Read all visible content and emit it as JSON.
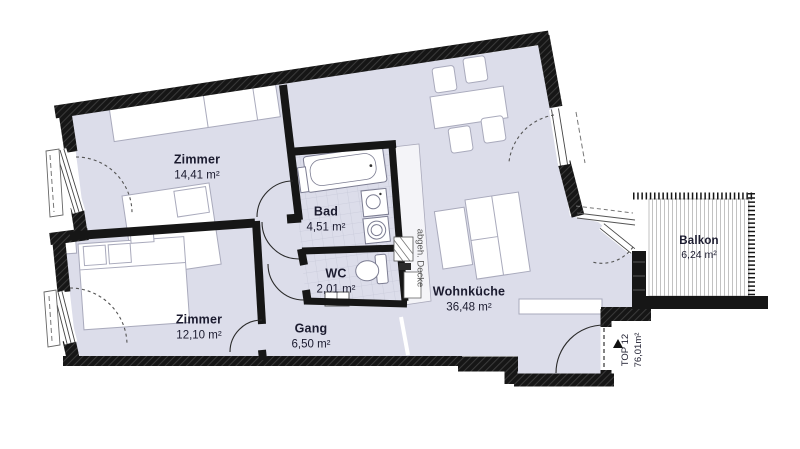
{
  "plan": {
    "title": "Wohnungsplan TOP 12",
    "rooms": [
      {
        "id": "zimmer-1",
        "name": "Zimmer",
        "area": "14,41 m²"
      },
      {
        "id": "zimmer-2",
        "name": "Zimmer",
        "area": "12,10 m²"
      },
      {
        "id": "bad",
        "name": "Bad",
        "area": "4,51 m²"
      },
      {
        "id": "wc",
        "name": "WC",
        "area": "2,01 m²"
      },
      {
        "id": "gang",
        "name": "Gang",
        "area": "6,50 m²"
      },
      {
        "id": "wohnkueche",
        "name": "Wohnküche",
        "area": "36,48 m²"
      },
      {
        "id": "balkon",
        "name": "Balkon",
        "area": "6,24 m²"
      }
    ],
    "unit": {
      "name": "TOP 12",
      "area": "76,01m²"
    },
    "annotations": {
      "ceiling": "abgeh. Decke"
    },
    "colors": {
      "floor": "#dcddea",
      "wall": "#161616",
      "furniture_stroke": "#a9aabc",
      "tile_line": "#c7c9d9",
      "label": "#1b1b2f",
      "annotation": "#555555"
    }
  }
}
